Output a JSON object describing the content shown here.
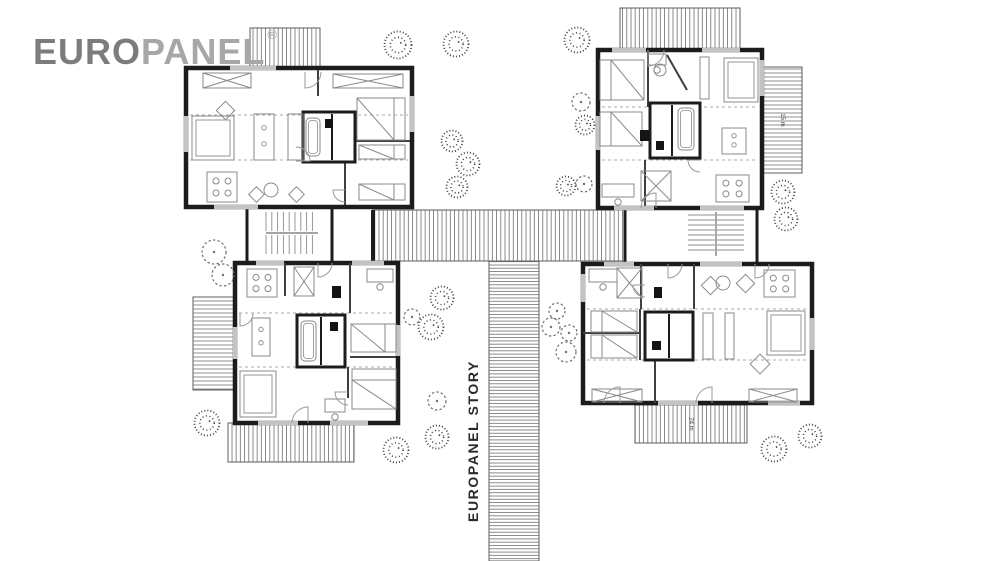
{
  "logo": {
    "euro": "EURO",
    "panel": "PANEL",
    "trademark": "®"
  },
  "walkway_label": "EUROPANEL STORY",
  "colors": {
    "wall": "#1c1c1c",
    "innerwall": "#3f3f3f",
    "furniture": "#8a8a8a",
    "hatch": "#6e6e6e",
    "dash": "#ababab",
    "window": "#c3c3c3",
    "tree_dark": "#3f3f3f",
    "tree_light": "#6f6f6f",
    "logo_euro": "#7b7c7e",
    "logo_panel": "#a6a7a9",
    "label": "#2a2a2a"
  },
  "plan": {
    "decks": [
      {
        "name": "deck-top-left",
        "x": 250,
        "y": 28,
        "w": 70,
        "h": 41,
        "hatch": "v",
        "label": ""
      },
      {
        "name": "deck-top-right",
        "x": 620,
        "y": 8,
        "w": 120,
        "h": 41,
        "hatch": "v",
        "label": ""
      },
      {
        "name": "deck-right",
        "x": 763,
        "y": 67,
        "w": 39,
        "h": 106,
        "hatch": "h",
        "label": "15 m"
      },
      {
        "name": "deck-left-bottom",
        "x": 193,
        "y": 297,
        "w": 42,
        "h": 93,
        "hatch": "h",
        "label": ""
      },
      {
        "name": "deck-bottom-left",
        "x": 228,
        "y": 423,
        "w": 126,
        "h": 39,
        "hatch": "v",
        "label": ""
      },
      {
        "name": "deck-bottom-right",
        "x": 635,
        "y": 405,
        "w": 112,
        "h": 38,
        "hatch": "v",
        "label": "24 m"
      },
      {
        "name": "walkway-horizontal",
        "x": 373,
        "y": 210,
        "w": 252,
        "h": 51,
        "hatch": "v",
        "label": ""
      },
      {
        "name": "walkway-vertical",
        "x": 489,
        "y": 261,
        "w": 50,
        "h": 300,
        "hatch": "hd",
        "label": ""
      }
    ],
    "stair_stub": [
      371,
      210,
      4,
      51
    ],
    "stairwells": [
      {
        "name": "stairwell-left",
        "box": [
          247,
          207,
          85,
          56
        ],
        "dir": "v",
        "a": 266,
        "b": 318,
        "step": 5.8,
        "bands": [
          [
            212,
            231
          ],
          [
            235,
            254
          ]
        ],
        "div": [
          266,
          233,
          318,
          233
        ]
      },
      {
        "name": "stairwell-right",
        "box": [
          625,
          207,
          132,
          58
        ],
        "dir": "h",
        "a": 215,
        "b": 253,
        "step": 5,
        "bands": [
          [
            688,
            715
          ],
          [
            717,
            744
          ]
        ],
        "div": [
          716,
          212,
          716,
          256
        ]
      }
    ],
    "buildings": [
      {
        "name": "building-top-left",
        "x": 186,
        "y": 68,
        "w": 226,
        "h": 139,
        "dash": [
          [
            115,
            190,
            408
          ],
          [
            160,
            190,
            408
          ]
        ],
        "iwalls": [
          [
            318,
            70,
            318,
            96
          ],
          [
            355,
            115,
            355,
            160
          ],
          [
            345,
            162,
            345,
            205
          ],
          [
            355,
            141,
            410,
            141
          ]
        ],
        "windows": [
          [
            186,
            116,
            186,
            152
          ],
          [
            230,
            68,
            276,
            68
          ],
          [
            214,
            207,
            258,
            207
          ],
          [
            412,
            96,
            412,
            132
          ]
        ],
        "core": [
          303,
          112,
          52,
          50
        ],
        "corelines": [
          [
            332,
            114,
            332,
            160
          ]
        ],
        "furn": [
          [
            "wardrobe",
            203,
            73,
            48,
            15,
            0
          ],
          [
            "wardrobe",
            333,
            74,
            70,
            14,
            0
          ],
          [
            "sofa",
            192,
            116,
            42,
            44,
            0
          ],
          [
            "diamond",
            219,
            104,
            13,
            0
          ],
          [
            "table",
            207,
            172,
            30,
            30,
            0
          ],
          [
            "kitchen",
            254,
            114,
            20,
            46,
            0
          ],
          [
            "counter",
            288,
            114,
            15,
            46,
            0
          ],
          [
            "bed",
            357,
            98,
            48,
            42,
            "r"
          ],
          [
            "bed",
            359,
            145,
            46,
            14,
            "r"
          ],
          [
            "bed",
            359,
            184,
            46,
            16,
            "r"
          ],
          [
            "circle",
            271,
            190,
            7,
            0,
            0
          ],
          [
            "diamond",
            251,
            189,
            11,
            0
          ],
          [
            "diamond",
            291,
            189,
            11,
            0
          ],
          [
            "bb",
            325,
            119,
            8,
            9,
            0
          ],
          [
            "tub",
            306,
            118,
            14,
            38,
            0
          ],
          [
            "door",
            305,
            72,
            16,
            0
          ],
          [
            "door",
            296,
            161,
            14,
            -90
          ],
          [
            "door",
            345,
            190,
            12,
            90
          ]
        ]
      },
      {
        "name": "building-top-right",
        "x": 598,
        "y": 50,
        "w": 164,
        "h": 158,
        "dash": [
          [
            107,
            602,
            758
          ],
          [
            160,
            602,
            758
          ]
        ],
        "iwalls": [
          [
            648,
            50,
            648,
            107
          ],
          [
            645,
            160,
            645,
            206
          ],
          [
            667,
            55,
            687,
            90
          ]
        ],
        "windows": [
          [
            612,
            50,
            646,
            50
          ],
          [
            702,
            50,
            740,
            50
          ],
          [
            762,
            60,
            762,
            96
          ],
          [
            598,
            116,
            598,
            150
          ],
          [
            614,
            208,
            654,
            208
          ],
          [
            700,
            208,
            744,
            208
          ]
        ],
        "core": [
          650,
          103,
          50,
          55
        ],
        "corelines": [
          [
            672,
            105,
            672,
            156
          ]
        ],
        "furn": [
          [
            "bed",
            600,
            60,
            44,
            40,
            "l"
          ],
          [
            "bed",
            600,
            112,
            42,
            34,
            "l"
          ],
          [
            "bb",
            640,
            130,
            9,
            11,
            0
          ],
          [
            "desk",
            648,
            54,
            18,
            11,
            0
          ],
          [
            "sofa",
            724,
            58,
            34,
            44,
            0
          ],
          [
            "counter",
            700,
            57,
            9,
            42,
            0
          ],
          [
            "circle",
            660,
            70,
            6,
            0,
            0
          ],
          [
            "kitchen",
            722,
            128,
            24,
            26,
            0
          ],
          [
            "table",
            716,
            175,
            33,
            27,
            0
          ],
          [
            "desk",
            602,
            184,
            32,
            13,
            0
          ],
          [
            "wardrobe",
            641,
            171,
            30,
            30,
            0
          ],
          [
            "tub",
            678,
            108,
            16,
            42,
            0
          ],
          [
            "bb",
            656,
            141,
            8,
            9,
            0
          ],
          [
            "door",
            648,
            50,
            16,
            0
          ],
          [
            "door",
            656,
            208,
            15,
            180
          ],
          [
            "door",
            700,
            160,
            12,
            90
          ]
        ]
      },
      {
        "name": "building-bottom-left",
        "x": 235,
        "y": 263,
        "w": 163,
        "h": 160,
        "dash": [
          [
            313,
            239,
            394
          ],
          [
            367,
            239,
            394
          ]
        ],
        "iwalls": [
          [
            285,
            263,
            285,
            296
          ],
          [
            350,
            263,
            350,
            313
          ],
          [
            348,
            367,
            348,
            398
          ],
          [
            350,
            357,
            396,
            357
          ]
        ],
        "windows": [
          [
            256,
            263,
            284,
            263
          ],
          [
            352,
            263,
            384,
            263
          ],
          [
            235,
            327,
            235,
            359
          ],
          [
            398,
            325,
            398,
            356
          ],
          [
            258,
            423,
            298,
            423
          ],
          [
            330,
            423,
            368,
            423
          ]
        ],
        "core": [
          297,
          315,
          48,
          52
        ],
        "corelines": [
          [
            321,
            317,
            321,
            365
          ]
        ],
        "furn": [
          [
            "table",
            247,
            269,
            30,
            28,
            0
          ],
          [
            "wardrobe",
            294,
            267,
            20,
            29,
            0
          ],
          [
            "bb",
            332,
            286,
            9,
            12,
            0
          ],
          [
            "desk",
            367,
            269,
            26,
            13,
            0
          ],
          [
            "kitchen",
            252,
            318,
            18,
            38,
            0
          ],
          [
            "bed",
            351,
            324,
            45,
            28,
            "r"
          ],
          [
            "bed",
            352,
            369,
            44,
            40,
            "t"
          ],
          [
            "sofa",
            240,
            371,
            36,
            46,
            0
          ],
          [
            "desk",
            325,
            399,
            20,
            13,
            0
          ],
          [
            "tub",
            301,
            321,
            15,
            40,
            0
          ],
          [
            "bb",
            330,
            322,
            8,
            9,
            0
          ],
          [
            "door",
            318,
            263,
            14,
            0
          ],
          [
            "door",
            308,
            423,
            16,
            180
          ],
          [
            "door",
            240,
            313,
            13,
            0
          ],
          [
            "door",
            348,
            392,
            13,
            90
          ]
        ]
      },
      {
        "name": "building-bottom-right",
        "x": 583,
        "y": 264,
        "w": 229,
        "h": 139,
        "dash": [
          [
            309,
            587,
            808
          ],
          [
            360,
            587,
            808
          ]
        ],
        "iwalls": [
          [
            641,
            264,
            641,
            309
          ],
          [
            694,
            264,
            694,
            309
          ],
          [
            640,
            309,
            640,
            360
          ],
          [
            583,
            333,
            640,
            333
          ],
          [
            655,
            360,
            655,
            403
          ]
        ],
        "windows": [
          [
            604,
            264,
            634,
            264
          ],
          [
            700,
            264,
            742,
            264
          ],
          [
            583,
            274,
            583,
            302
          ],
          [
            812,
            318,
            812,
            350
          ],
          [
            658,
            403,
            698,
            403
          ],
          [
            768,
            403,
            800,
            403
          ]
        ],
        "core": [
          645,
          312,
          48,
          48
        ],
        "corelines": [
          [
            669,
            314,
            669,
            358
          ]
        ],
        "furn": [
          [
            "desk",
            589,
            269,
            28,
            13,
            0
          ],
          [
            "wardrobe",
            617,
            268,
            25,
            30,
            0
          ],
          [
            "bb",
            654,
            287,
            8,
            11,
            0
          ],
          [
            "diamond",
            704,
            279,
            13,
            0
          ],
          [
            "circle",
            723,
            283,
            7,
            0,
            0
          ],
          [
            "diamond",
            739,
            277,
            13,
            0
          ],
          [
            "table",
            764,
            270,
            31,
            27,
            0
          ],
          [
            "bed",
            591,
            311,
            46,
            21,
            "l"
          ],
          [
            "bed",
            591,
            335,
            46,
            23,
            "l"
          ],
          [
            "counter",
            703,
            313,
            10,
            46,
            0
          ],
          [
            "counter",
            725,
            313,
            9,
            46,
            0
          ],
          [
            "sofa",
            767,
            311,
            38,
            44,
            0
          ],
          [
            "diamond",
            753,
            357,
            14,
            0
          ],
          [
            "wardrobe",
            749,
            389,
            48,
            13,
            0
          ],
          [
            "wardrobe",
            592,
            389,
            50,
            13,
            0
          ],
          [
            "bb",
            652,
            341,
            9,
            9,
            0
          ],
          [
            "door",
            645,
            285,
            12,
            90
          ],
          [
            "door",
            668,
            264,
            14,
            0
          ],
          [
            "door",
            620,
            403,
            16,
            180
          ],
          [
            "door",
            712,
            403,
            16,
            180
          ],
          [
            "door",
            755,
            264,
            14,
            0
          ]
        ]
      }
    ],
    "trees": [
      [
        398,
        45,
        14,
        "s"
      ],
      [
        456,
        44,
        13,
        "s"
      ],
      [
        577,
        40,
        13,
        "s"
      ],
      [
        581,
        102,
        9,
        "o"
      ],
      [
        585,
        125,
        10,
        "s"
      ],
      [
        452,
        141,
        11,
        "s"
      ],
      [
        468,
        164,
        12,
        "s"
      ],
      [
        457,
        187,
        11,
        "s"
      ],
      [
        566,
        186,
        10,
        "s"
      ],
      [
        584,
        184,
        8,
        "o"
      ],
      [
        783,
        192,
        12,
        "s"
      ],
      [
        786,
        219,
        12,
        "s"
      ],
      [
        214,
        252,
        12,
        "o"
      ],
      [
        223,
        275,
        11,
        "o"
      ],
      [
        442,
        298,
        12,
        "s"
      ],
      [
        412,
        317,
        8,
        "o"
      ],
      [
        431,
        327,
        13,
        "s"
      ],
      [
        557,
        311,
        8,
        "o"
      ],
      [
        551,
        327,
        9,
        "o"
      ],
      [
        569,
        333,
        8,
        "o"
      ],
      [
        566,
        352,
        10,
        "o"
      ],
      [
        437,
        401,
        9,
        "o"
      ],
      [
        437,
        437,
        12,
        "s"
      ],
      [
        207,
        423,
        13,
        "s"
      ],
      [
        396,
        450,
        13,
        "s"
      ],
      [
        774,
        449,
        13,
        "s"
      ],
      [
        810,
        436,
        12,
        "s"
      ]
    ]
  }
}
